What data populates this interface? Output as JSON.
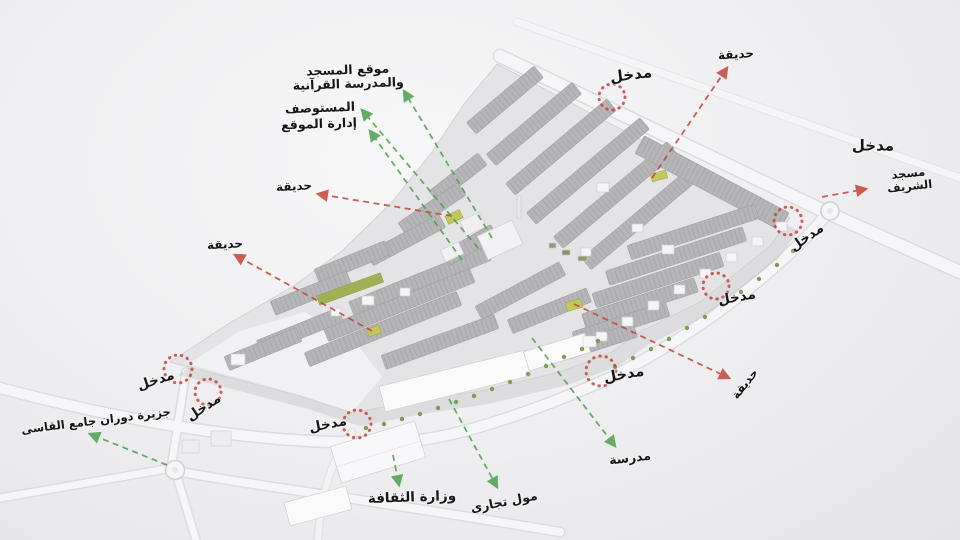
{
  "colors": {
    "red": "#c2453c",
    "green": "#4d9e4f",
    "marker": "#c2453c",
    "text": "#161616",
    "site": "#e4e4e6",
    "block": "#b6b6b8",
    "road": "#f6f6f8",
    "tree": "#7f9c55",
    "garden_patch": "#c3c75a"
  },
  "labels": [
    {
      "name": "label-mosque-quran-school",
      "text": "موقع المسجد\nوالمدرسة القرآنية",
      "x": 348,
      "y": 77,
      "rot": -2,
      "size": 12.5
    },
    {
      "name": "label-clinic",
      "text": "المستوصف",
      "x": 320,
      "y": 108,
      "rot": -2,
      "size": 12.5
    },
    {
      "name": "label-site-admin",
      "text": "إدارة الموقع",
      "x": 319,
      "y": 124,
      "rot": -2,
      "size": 12.5
    },
    {
      "name": "label-garden-ne",
      "text": "حديقة",
      "x": 736,
      "y": 55,
      "rot": -4,
      "size": 12
    },
    {
      "name": "label-entrance-n",
      "text": "مدخل",
      "x": 631,
      "y": 75,
      "rot": -7,
      "size": 15
    },
    {
      "name": "label-entrance-ne-road",
      "text": "مدخل",
      "x": 873,
      "y": 146,
      "rot": 0,
      "size": 15
    },
    {
      "name": "label-sharif-mosque",
      "text": "مسجد الشريف",
      "x": 909,
      "y": 180,
      "rot": -6,
      "size": 11.5
    },
    {
      "name": "label-entrance-e",
      "text": "مدخل",
      "x": 807,
      "y": 238,
      "rot": -35,
      "size": 13.5
    },
    {
      "name": "label-entrance-e2",
      "text": "مدخل",
      "x": 737,
      "y": 298,
      "rot": -10,
      "size": 13.5
    },
    {
      "name": "label-garden-se",
      "text": "حديقة",
      "x": 745,
      "y": 384,
      "rot": -52,
      "size": 11.5
    },
    {
      "name": "label-entrance-s",
      "text": "مدخل",
      "x": 624,
      "y": 375,
      "rot": -10,
      "size": 14.5
    },
    {
      "name": "label-school",
      "text": "مدرسة",
      "x": 630,
      "y": 458,
      "rot": -7,
      "size": 12.5
    },
    {
      "name": "label-mall",
      "text": "مول تجارى",
      "x": 504,
      "y": 502,
      "rot": -11,
      "size": 12.5
    },
    {
      "name": "label-culture-ministry",
      "text": "وزارة الثقافة",
      "x": 412,
      "y": 498,
      "rot": -2,
      "size": 13.5
    },
    {
      "name": "label-entrance-sw",
      "text": "مدخل",
      "x": 328,
      "y": 425,
      "rot": -11,
      "size": 13.5
    },
    {
      "name": "label-entrance-w1",
      "text": "مدخل",
      "x": 156,
      "y": 381,
      "rot": -18,
      "size": 13.5
    },
    {
      "name": "label-entrance-w2",
      "text": "مدخل",
      "x": 204,
      "y": 408,
      "rot": -33,
      "size": 13.5
    },
    {
      "name": "label-qasi-roundabout",
      "text": "جزيرة دوران جامع القاسى",
      "x": 96,
      "y": 421,
      "rot": -7,
      "size": 11.5
    },
    {
      "name": "label-garden-w1",
      "text": "حديقة",
      "x": 294,
      "y": 187,
      "rot": -3,
      "size": 12
    },
    {
      "name": "label-garden-w2",
      "text": "حديقة",
      "x": 225,
      "y": 245,
      "rot": -3,
      "size": 12
    }
  ],
  "arrows": [
    {
      "name": "arrow-garden-ne",
      "color": "red",
      "x1": 652,
      "y1": 178,
      "x2": 727,
      "y2": 68
    },
    {
      "name": "arrow-garden-w1",
      "color": "red",
      "x1": 452,
      "y1": 216,
      "x2": 318,
      "y2": 194
    },
    {
      "name": "arrow-garden-w2",
      "color": "red",
      "x1": 372,
      "y1": 331,
      "x2": 235,
      "y2": 255
    },
    {
      "name": "arrow-garden-se",
      "color": "red",
      "x1": 574,
      "y1": 304,
      "x2": 729,
      "y2": 378
    },
    {
      "name": "arrow-sharif-mosque",
      "color": "red",
      "x1": 822,
      "y1": 197,
      "x2": 866,
      "y2": 189
    },
    {
      "name": "arrow-mosque-quran-school",
      "color": "green",
      "x1": 492,
      "y1": 238,
      "x2": 404,
      "y2": 91
    },
    {
      "name": "arrow-clinic",
      "color": "green",
      "x1": 478,
      "y1": 248,
      "x2": 362,
      "y2": 110
    },
    {
      "name": "arrow-site-admin",
      "color": "green",
      "x1": 462,
      "y1": 260,
      "x2": 370,
      "y2": 131
    },
    {
      "name": "arrow-qasi-roundabout",
      "color": "green",
      "x1": 167,
      "y1": 465,
      "x2": 90,
      "y2": 434
    },
    {
      "name": "arrow-mall",
      "color": "green",
      "x1": 449,
      "y1": 399,
      "x2": 497,
      "y2": 487
    },
    {
      "name": "arrow-school",
      "color": "green",
      "x1": 532,
      "y1": 338,
      "x2": 615,
      "y2": 446
    },
    {
      "name": "arrow-culture-ministry",
      "color": "green",
      "x1": 393,
      "y1": 455,
      "x2": 399,
      "y2": 485
    }
  ],
  "entrances": [
    {
      "name": "entrance-marker-n",
      "x": 612,
      "y": 97,
      "r": 13
    },
    {
      "name": "entrance-marker-e",
      "x": 788,
      "y": 221,
      "r": 14
    },
    {
      "name": "entrance-marker-e2",
      "x": 716,
      "y": 286,
      "r": 13
    },
    {
      "name": "entrance-marker-s",
      "x": 601,
      "y": 371,
      "r": 15
    },
    {
      "name": "entrance-marker-sw",
      "x": 357,
      "y": 424,
      "r": 14
    },
    {
      "name": "entrance-marker-w1",
      "x": 178,
      "y": 369,
      "r": 14
    },
    {
      "name": "entrance-marker-w2",
      "x": 208,
      "y": 392,
      "r": 13
    }
  ]
}
